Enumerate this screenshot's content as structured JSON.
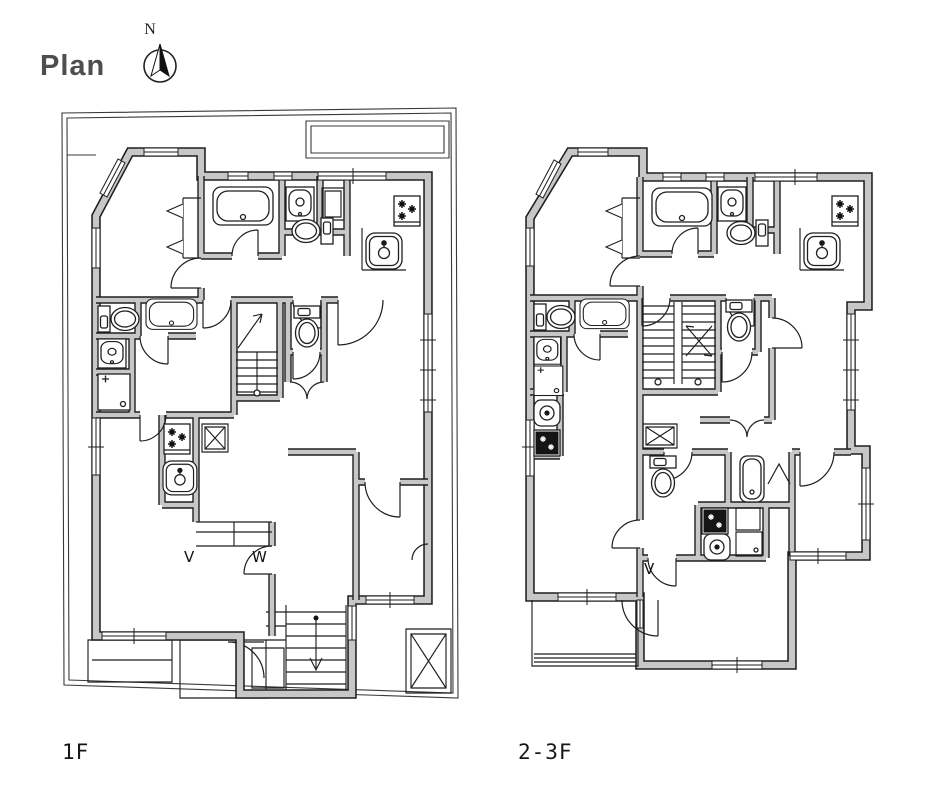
{
  "header": {
    "title": "Plan",
    "north_label": "N"
  },
  "floors": {
    "f1": {
      "label": "1F"
    },
    "f23": {
      "label": "2-3F"
    }
  },
  "marks": {
    "v": "V",
    "w": "W",
    "v2": "V"
  },
  "colors": {
    "wall": "#c7c7c7",
    "line": "#1f1f1f",
    "site": "#3a3a3a",
    "title": "#4e4e4e",
    "label": "#161616",
    "bg": "#ffffff"
  },
  "fixtures_legend": [
    "bathtub",
    "washbasin",
    "toilet",
    "gas-stove",
    "kitchen-sink",
    "washing-machine",
    "staircase",
    "pipe-shaft",
    "elevator",
    "balcony",
    "closet",
    "north-arrow",
    "parking-area",
    "terrace"
  ]
}
